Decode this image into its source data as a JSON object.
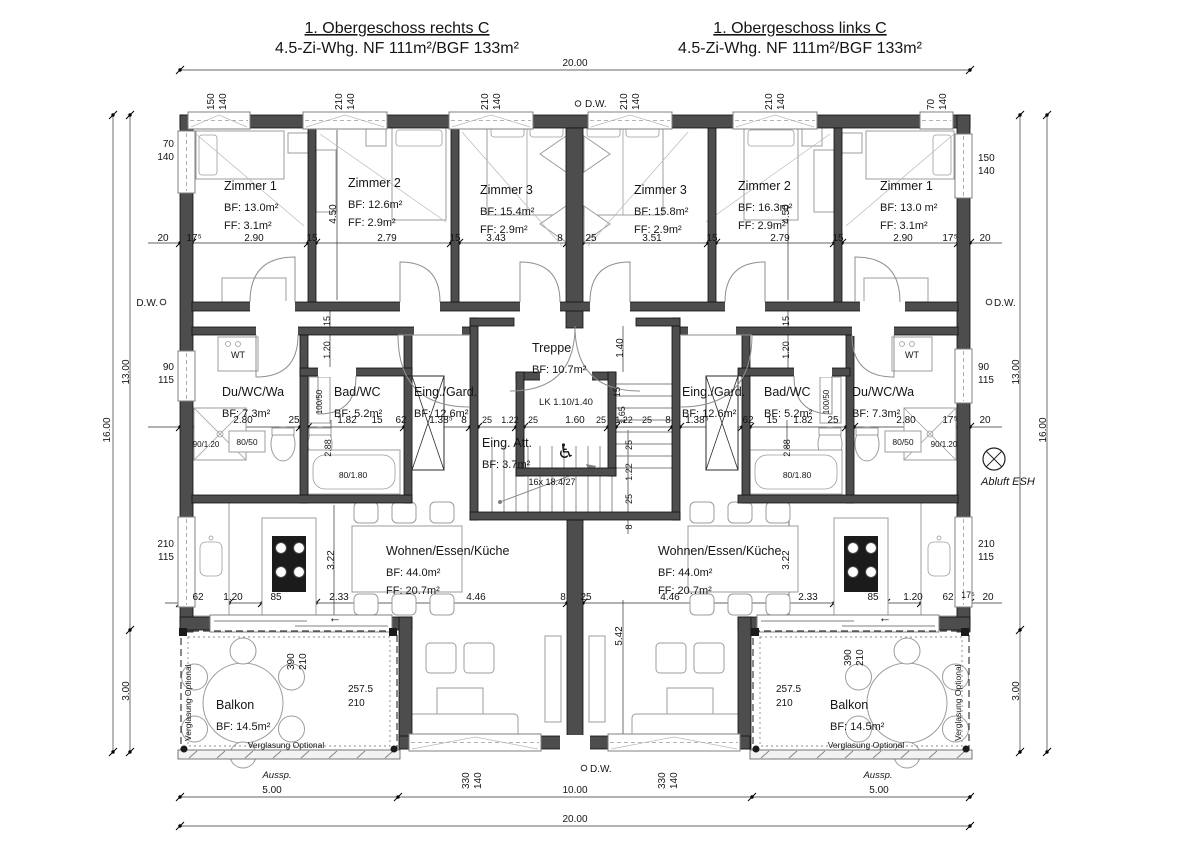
{
  "drawing": {
    "kind": "architectural-floor-plan",
    "ink": "#151515",
    "wall_color": "#4d4d4d"
  },
  "titles": {
    "left": {
      "line1": "1. Obergeschoss rechts C",
      "line2": "4.5-Zi-Whg. NF 111m²/BGF 133m²"
    },
    "right": {
      "line1": "1. Obergeschoss links C",
      "line2": "4.5-Zi-Whg. NF 111m²/BGF 133m²"
    }
  },
  "rooms": [
    {
      "id": "zimmer1-left",
      "x": 224,
      "y": 190,
      "lines": [
        "Zimmer 1",
        "BF: 13.0m²",
        "FF: 3.1m²"
      ]
    },
    {
      "id": "zimmer2-left",
      "x": 348,
      "y": 187,
      "lines": [
        "Zimmer 2",
        "BF: 12.6m²",
        "FF: 2.9m²"
      ]
    },
    {
      "id": "zimmer3-left",
      "x": 480,
      "y": 194,
      "lines": [
        "Zimmer 3",
        "BF: 15.4m²",
        "FF: 2.9m²"
      ]
    },
    {
      "id": "zimmer3-right",
      "x": 634,
      "y": 194,
      "lines": [
        "Zimmer 3",
        "BF: 15.8m²",
        "FF: 2.9m²"
      ]
    },
    {
      "id": "zimmer2-right",
      "x": 738,
      "y": 190,
      "lines": [
        "Zimmer 2",
        "BF: 16.3m²",
        "FF: 2.9m²"
      ]
    },
    {
      "id": "zimmer1-right",
      "x": 880,
      "y": 190,
      "lines": [
        "Zimmer 1",
        "BF: 13.0 m²",
        "FF: 3.1m²"
      ]
    },
    {
      "id": "treppe",
      "x": 532,
      "y": 352,
      "lines": [
        "Treppe",
        "BF: 10.7m²"
      ]
    },
    {
      "id": "du-wc-wa-left",
      "x": 222,
      "y": 396,
      "lines": [
        "Du/WC/Wa",
        "BF: 7.3m²"
      ]
    },
    {
      "id": "bad-wc-left",
      "x": 334,
      "y": 396,
      "lines": [
        "Bad/WC",
        "BF: 5.2m²"
      ]
    },
    {
      "id": "eing-gard-left",
      "x": 414,
      "y": 396,
      "lines": [
        "Eing./Gard.",
        "BF: 12.6m²"
      ]
    },
    {
      "id": "eing-att",
      "x": 482,
      "y": 447,
      "lines": [
        "Eing. Att.",
        "BF: 3.7m²"
      ]
    },
    {
      "id": "eing-gard-right",
      "x": 682,
      "y": 396,
      "lines": [
        "Eing./Gard.",
        "BF: 12.6m²"
      ]
    },
    {
      "id": "bad-wc-right",
      "x": 764,
      "y": 396,
      "lines": [
        "Bad/WC",
        "BF: 5.2m²"
      ]
    },
    {
      "id": "du-wc-wa-right",
      "x": 852,
      "y": 396,
      "lines": [
        "Du/WC/Wa",
        "BF: 7.3m²"
      ]
    },
    {
      "id": "wohnen-left",
      "x": 386,
      "y": 555,
      "lines": [
        "Wohnen/Essen/Küche",
        "BF: 44.0m²",
        "FF: 20.7m²"
      ]
    },
    {
      "id": "wohnen-right",
      "x": 658,
      "y": 555,
      "lines": [
        "Wohnen/Essen/Küche",
        "BF: 44.0m²",
        "FF: 20.7m²"
      ]
    },
    {
      "id": "balkon-left",
      "x": 216,
      "y": 709,
      "lines": [
        "Balkon",
        "BF: 14.5m²"
      ]
    },
    {
      "id": "balkon-right",
      "x": 830,
      "y": 709,
      "lines": [
        "Balkon",
        "BF: 14.5m²"
      ]
    }
  ],
  "annotations": [
    {
      "t": "20.00",
      "x": 575,
      "y": 66
    },
    {
      "t": "150",
      "x": 214,
      "y": 110,
      "r": -90,
      "a": "s",
      "n": "win"
    },
    {
      "t": "140",
      "x": 226,
      "y": 110,
      "r": -90,
      "a": "s",
      "n": "win"
    },
    {
      "t": "210",
      "x": 342,
      "y": 110,
      "r": -90,
      "a": "s",
      "n": "win"
    },
    {
      "t": "140",
      "x": 354,
      "y": 110,
      "r": -90,
      "a": "s",
      "n": "win"
    },
    {
      "t": "210",
      "x": 488,
      "y": 110,
      "r": -90,
      "a": "s",
      "n": "win"
    },
    {
      "t": "140",
      "x": 500,
      "y": 110,
      "r": -90,
      "a": "s",
      "n": "win"
    },
    {
      "t": "D.W.",
      "x": 585,
      "y": 107,
      "a": "s",
      "n": "dw"
    },
    {
      "t": "210",
      "x": 627,
      "y": 110,
      "r": -90,
      "a": "s",
      "n": "win"
    },
    {
      "t": "140",
      "x": 639,
      "y": 110,
      "r": -90,
      "a": "s",
      "n": "win"
    },
    {
      "t": "210",
      "x": 772,
      "y": 110,
      "r": -90,
      "a": "s",
      "n": "win"
    },
    {
      "t": "140",
      "x": 784,
      "y": 110,
      "r": -90,
      "a": "s",
      "n": "win"
    },
    {
      "t": "70",
      "x": 934,
      "y": 110,
      "r": -90,
      "a": "s",
      "n": "win"
    },
    {
      "t": "140",
      "x": 946,
      "y": 110,
      "r": -90,
      "a": "s",
      "n": "win"
    },
    {
      "t": "70",
      "x": 174,
      "y": 147,
      "a": "e",
      "n": "win"
    },
    {
      "t": "140",
      "x": 174,
      "y": 160,
      "a": "e",
      "n": "win"
    },
    {
      "t": "D.W.",
      "x": 158,
      "y": 306,
      "a": "e",
      "n": "dw"
    },
    {
      "t": "90",
      "x": 174,
      "y": 370,
      "a": "e",
      "n": "win"
    },
    {
      "t": "115",
      "x": 174,
      "y": 383,
      "a": "e",
      "n": "win"
    },
    {
      "t": "210",
      "x": 174,
      "y": 547,
      "a": "e",
      "n": "win"
    },
    {
      "t": "115",
      "x": 174,
      "y": 560,
      "a": "e",
      "n": "win"
    },
    {
      "t": "16.00",
      "x": 110,
      "y": 430,
      "r": -90
    },
    {
      "t": "13.00",
      "x": 129,
      "y": 372,
      "r": -90
    },
    {
      "t": "3.00",
      "x": 129,
      "y": 691,
      "r": -90
    },
    {
      "t": "150",
      "x": 978,
      "y": 161,
      "a": "s",
      "n": "win"
    },
    {
      "t": "140",
      "x": 978,
      "y": 174,
      "a": "s",
      "n": "win"
    },
    {
      "t": "D.W.",
      "x": 994,
      "y": 306,
      "a": "s",
      "n": "dw"
    },
    {
      "t": "90",
      "x": 978,
      "y": 370,
      "a": "s",
      "n": "win"
    },
    {
      "t": "115",
      "x": 978,
      "y": 383,
      "a": "s",
      "n": "win"
    },
    {
      "t": "210",
      "x": 978,
      "y": 547,
      "a": "s",
      "n": "win"
    },
    {
      "t": "115",
      "x": 978,
      "y": 560,
      "a": "s",
      "n": "win"
    },
    {
      "t": "13.00",
      "x": 1019,
      "y": 372,
      "r": -90
    },
    {
      "t": "16.00",
      "x": 1046,
      "y": 430,
      "r": -90
    },
    {
      "t": "3.00",
      "x": 1019,
      "y": 691,
      "r": -90
    },
    {
      "t": "Abluft ESH",
      "x": 981,
      "y": 485,
      "a": "s",
      "i": true,
      "s": 11,
      "n": "note"
    },
    {
      "t": "20",
      "x": 163,
      "y": 241
    },
    {
      "t": "17⁵",
      "x": 194,
      "y": 241
    },
    {
      "t": "2.90",
      "x": 254,
      "y": 241
    },
    {
      "t": "15",
      "x": 312,
      "y": 241
    },
    {
      "t": "2.79",
      "x": 387,
      "y": 241
    },
    {
      "t": "15",
      "x": 455,
      "y": 241
    },
    {
      "t": "3.43",
      "x": 496,
      "y": 241
    },
    {
      "t": "8",
      "x": 560,
      "y": 241
    },
    {
      "t": "25",
      "x": 591,
      "y": 241
    },
    {
      "t": "3.51",
      "x": 652,
      "y": 241
    },
    {
      "t": "15",
      "x": 712,
      "y": 241
    },
    {
      "t": "2.79",
      "x": 780,
      "y": 241
    },
    {
      "t": "15",
      "x": 838,
      "y": 241
    },
    {
      "t": "2.90",
      "x": 903,
      "y": 241
    },
    {
      "t": "17⁵",
      "x": 950,
      "y": 241
    },
    {
      "t": "20",
      "x": 985,
      "y": 241
    },
    {
      "t": "4.50",
      "x": 336,
      "y": 214,
      "r": -90
    },
    {
      "t": "4.50",
      "x": 789,
      "y": 214,
      "r": -90
    },
    {
      "t": "15",
      "x": 330,
      "y": 321,
      "r": -90,
      "s": 9
    },
    {
      "t": "1.20",
      "x": 330,
      "y": 350,
      "r": -90,
      "s": 9
    },
    {
      "t": "15",
      "x": 789,
      "y": 321,
      "r": -90,
      "s": 9
    },
    {
      "t": "1.20",
      "x": 789,
      "y": 350,
      "r": -90,
      "s": 9
    },
    {
      "t": "1.40",
      "x": 623,
      "y": 348,
      "r": -90
    },
    {
      "t": "15",
      "x": 620,
      "y": 392,
      "r": -90,
      "s": 9
    },
    {
      "t": "1.65",
      "x": 625,
      "y": 415,
      "r": -90,
      "s": 9
    },
    {
      "t": "25",
      "x": 632,
      "y": 445,
      "r": -90,
      "s": 9
    },
    {
      "t": "1.22",
      "x": 632,
      "y": 472,
      "r": -90,
      "s": 9
    },
    {
      "t": "25",
      "x": 632,
      "y": 499,
      "r": -90,
      "s": 9
    },
    {
      "t": "8",
      "x": 632,
      "y": 527,
      "r": -90,
      "s": 9
    },
    {
      "t": "5.42",
      "x": 622,
      "y": 636,
      "r": -90
    },
    {
      "t": "2.88",
      "x": 331,
      "y": 448,
      "r": -90,
      "s": 9
    },
    {
      "t": "2.88",
      "x": 790,
      "y": 448,
      "r": -90,
      "s": 9
    },
    {
      "t": "2.80",
      "x": 243,
      "y": 423
    },
    {
      "t": "25",
      "x": 294,
      "y": 423
    },
    {
      "t": "1.82",
      "x": 347,
      "y": 423
    },
    {
      "t": "15",
      "x": 377,
      "y": 423
    },
    {
      "t": "62",
      "x": 401,
      "y": 423
    },
    {
      "t": "1.38⁵",
      "x": 441,
      "y": 423
    },
    {
      "t": "8",
      "x": 464,
      "y": 423
    },
    {
      "t": "25",
      "x": 487,
      "y": 423,
      "s": 9
    },
    {
      "t": "1.22",
      "x": 510,
      "y": 423,
      "s": 9
    },
    {
      "t": "25",
      "x": 533,
      "y": 423,
      "s": 9
    },
    {
      "t": "1.60",
      "x": 575,
      "y": 423
    },
    {
      "t": "25",
      "x": 601,
      "y": 423,
      "s": 9
    },
    {
      "t": "1.22",
      "x": 624,
      "y": 423,
      "s": 9
    },
    {
      "t": "25",
      "x": 647,
      "y": 423,
      "s": 9
    },
    {
      "t": "8",
      "x": 668,
      "y": 423
    },
    {
      "t": "1.38⁵",
      "x": 697,
      "y": 423
    },
    {
      "t": "62",
      "x": 748,
      "y": 423
    },
    {
      "t": "15",
      "x": 772,
      "y": 423
    },
    {
      "t": "1.82",
      "x": 803,
      "y": 423
    },
    {
      "t": "25",
      "x": 833,
      "y": 423
    },
    {
      "t": "2.80",
      "x": 906,
      "y": 423
    },
    {
      "t": "17⁵",
      "x": 950,
      "y": 423
    },
    {
      "t": "20",
      "x": 985,
      "y": 423
    },
    {
      "t": "62",
      "x": 198,
      "y": 600
    },
    {
      "t": "1.20",
      "x": 233,
      "y": 600
    },
    {
      "t": "85",
      "x": 276,
      "y": 600
    },
    {
      "t": "2.33",
      "x": 339,
      "y": 600
    },
    {
      "t": "4.46",
      "x": 476,
      "y": 600
    },
    {
      "t": "8",
      "x": 563,
      "y": 600
    },
    {
      "t": "25",
      "x": 586,
      "y": 600
    },
    {
      "t": "4.46",
      "x": 670,
      "y": 600
    },
    {
      "t": "2.33",
      "x": 808,
      "y": 600
    },
    {
      "t": "85",
      "x": 873,
      "y": 600
    },
    {
      "t": "1.20",
      "x": 913,
      "y": 600
    },
    {
      "t": "62",
      "x": 948,
      "y": 600
    },
    {
      "t": "17⁵",
      "x": 968,
      "y": 598,
      "s": 9
    },
    {
      "t": "20",
      "x": 988,
      "y": 600
    },
    {
      "t": "3.22",
      "x": 334,
      "y": 560,
      "r": -90
    },
    {
      "t": "3.22",
      "x": 789,
      "y": 560,
      "r": -90
    },
    {
      "t": "WT",
      "x": 238,
      "y": 358,
      "s": 9,
      "n": "fix"
    },
    {
      "t": "WT",
      "x": 912,
      "y": 358,
      "s": 9,
      "n": "fix"
    },
    {
      "t": "100/50",
      "x": 322,
      "y": 402,
      "r": -90,
      "s": 8,
      "n": "fix"
    },
    {
      "t": "100/50",
      "x": 829,
      "y": 402,
      "r": -90,
      "s": 8,
      "n": "fix"
    },
    {
      "t": "80/50",
      "x": 247,
      "y": 445,
      "s": 8.5,
      "n": "fix"
    },
    {
      "t": "80/50",
      "x": 903,
      "y": 445,
      "s": 8.5,
      "n": "fix"
    },
    {
      "t": "90/1.20",
      "x": 206,
      "y": 447,
      "s": 8,
      "n": "fix"
    },
    {
      "t": "90/1.20",
      "x": 944,
      "y": 447,
      "s": 8,
      "n": "fix"
    },
    {
      "t": "80/1.80",
      "x": 353,
      "y": 478,
      "s": 8.5,
      "n": "fix"
    },
    {
      "t": "80/1.80",
      "x": 797,
      "y": 478,
      "s": 8.5,
      "n": "fix"
    },
    {
      "t": "LK 1.10/1.40",
      "x": 566,
      "y": 405,
      "s": 9.5,
      "n": "fix"
    },
    {
      "t": "16x 18.4/27",
      "x": 552,
      "y": 485,
      "s": 9,
      "n": "note"
    },
    {
      "t": "♿",
      "x": 566,
      "y": 458,
      "s": 20,
      "n": "wheelchair-icon"
    },
    {
      "t": "←",
      "x": 335,
      "y": 622,
      "s": 13,
      "n": "arrow"
    },
    {
      "t": "←",
      "x": 885,
      "y": 622,
      "s": 13,
      "n": "arrow"
    },
    {
      "t": "390",
      "x": 294,
      "y": 670,
      "r": -90,
      "a": "s",
      "n": "win"
    },
    {
      "t": "210",
      "x": 306,
      "y": 670,
      "r": -90,
      "a": "s",
      "n": "win"
    },
    {
      "t": "257.5",
      "x": 348,
      "y": 692,
      "a": "s"
    },
    {
      "t": "210",
      "x": 348,
      "y": 706,
      "a": "s"
    },
    {
      "t": "Verglasung Optional",
      "x": 191,
      "y": 741,
      "r": -90,
      "a": "s",
      "s": 8.5,
      "n": "note"
    },
    {
      "t": "Verglasung Optional",
      "x": 286,
      "y": 748,
      "s": 8.5,
      "n": "note"
    },
    {
      "t": "390",
      "x": 851,
      "y": 666,
      "r": -90,
      "a": "s",
      "n": "win"
    },
    {
      "t": "210",
      "x": 863,
      "y": 666,
      "r": -90,
      "a": "s",
      "n": "win"
    },
    {
      "t": "257.5",
      "x": 776,
      "y": 692,
      "a": "s"
    },
    {
      "t": "210",
      "x": 776,
      "y": 706,
      "a": "s"
    },
    {
      "t": "Verglasung Optional",
      "x": 961,
      "y": 741,
      "r": -90,
      "a": "s",
      "s": 8.5,
      "n": "note"
    },
    {
      "t": "Verglasung Optional",
      "x": 866,
      "y": 748,
      "s": 8.5,
      "n": "note"
    },
    {
      "t": "330",
      "x": 469,
      "y": 789,
      "r": -90,
      "a": "s",
      "n": "win"
    },
    {
      "t": "140",
      "x": 481,
      "y": 789,
      "r": -90,
      "a": "s",
      "n": "win"
    },
    {
      "t": "D.W.",
      "x": 590,
      "y": 772,
      "a": "s",
      "n": "dw"
    },
    {
      "t": "330",
      "x": 665,
      "y": 789,
      "r": -90,
      "a": "s",
      "n": "win"
    },
    {
      "t": "140",
      "x": 677,
      "y": 789,
      "r": -90,
      "a": "s",
      "n": "win"
    },
    {
      "t": "Aussp.",
      "x": 277,
      "y": 778,
      "i": true,
      "s": 9.5,
      "n": "note"
    },
    {
      "t": "5.00",
      "x": 272,
      "y": 793
    },
    {
      "t": "Aussp.",
      "x": 878,
      "y": 778,
      "i": true,
      "s": 9.5,
      "n": "note"
    },
    {
      "t": "5.00",
      "x": 879,
      "y": 793
    },
    {
      "t": "10.00",
      "x": 575,
      "y": 793
    },
    {
      "t": "20.00",
      "x": 575,
      "y": 822
    }
  ]
}
